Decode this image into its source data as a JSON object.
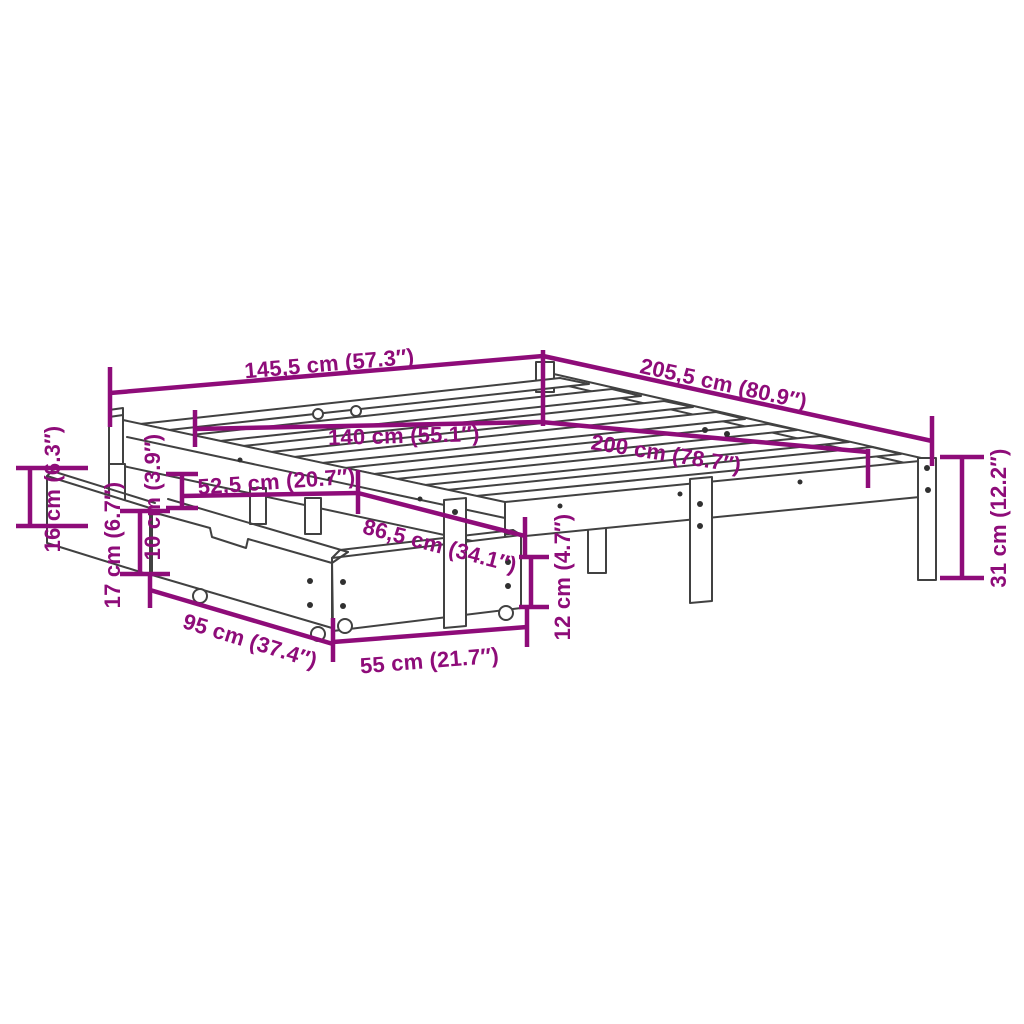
{
  "diagram": {
    "kind": "product-dimension-diagram",
    "subject": "bed-frame-with-two-storage-drawers",
    "background_color": "#ffffff",
    "art_color": "#414141",
    "dimension_color": "#8E0C79",
    "dimensions": {
      "outer_width": "145,5 cm (57.3″)",
      "outer_length": "205,5 cm (80.9″)",
      "mattress_width": "140 cm (55.1″)",
      "mattress_length": "200 cm (78.7″)",
      "drawer_offset_width": "52,5 cm (20.7″)",
      "drawer_offset_length": "86,5 cm (34.1″)",
      "rail_height": "16 cm (6.3″)",
      "under_bed_clearance": "10 cm (3.9″)",
      "drawer_total_height": "17 cm (6.7″)",
      "drawer_box_height": "12 cm (4.7″)",
      "drawer_depth": "95 cm (37.4″)",
      "drawer_width": "55 cm (21.7″)",
      "leg_height": "31 cm (12.2″)"
    }
  }
}
